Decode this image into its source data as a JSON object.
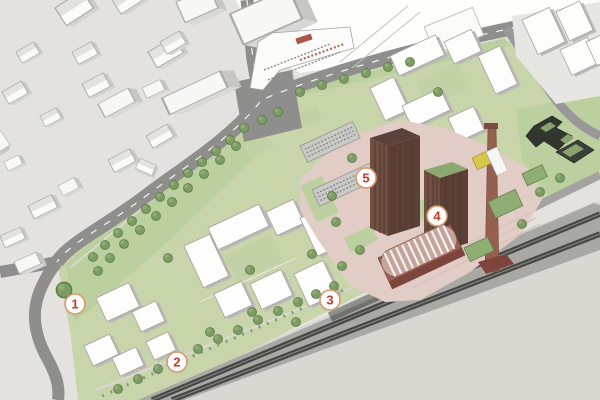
{
  "markers": [
    {
      "label": "1",
      "x": 75,
      "y": 304
    },
    {
      "label": "2",
      "x": 177,
      "y": 362
    },
    {
      "label": "3",
      "x": 330,
      "y": 300
    },
    {
      "label": "4",
      "x": 437,
      "y": 216
    },
    {
      "label": "5",
      "x": 366,
      "y": 178
    }
  ],
  "colors": {
    "marker-ring": "#d59a6d",
    "marker-number": "#c13d2a",
    "marker-fill": "#ffffff",
    "context-ground": "#e3e2df",
    "site-green": "#c8d5ab",
    "tree-green": "#7d9c63",
    "road-grey": "#8e8e8c",
    "railway-dark": "#474745",
    "brick-brown": "#6e4f42",
    "chimney-brick": "#96604f",
    "paving-pink": "#e2cdc6",
    "green-roof": "#8fae73",
    "dark-building": "#31362f",
    "white-building": "#fdfdfc",
    "vacant-beige": "#d9d7d1"
  }
}
